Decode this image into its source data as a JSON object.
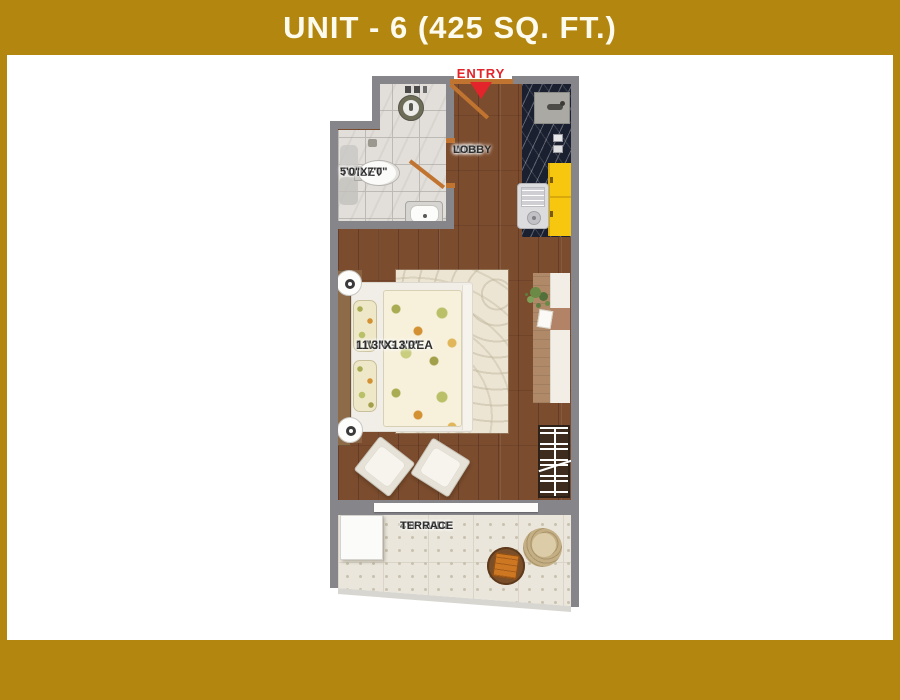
{
  "title": {
    "text": "UNIT - 6 (425 SQ. FT.)"
  },
  "plan": {
    "entry_label": "ENTRY",
    "rooms": {
      "lobby": {
        "line1": "4'0\"",
        "line2": "WIDE",
        "line3": "LOBBY"
      },
      "toilet": {
        "name": "TOILET",
        "size": "5'0\"X7'0\""
      },
      "living": {
        "name": "LIVING AREA",
        "size": "11'3\"X13'0\""
      },
      "terrace": {
        "line1": "4'0\" WIDE",
        "line2": "TERRACE"
      }
    }
  },
  "colors": {
    "frame_gold": "#B3870F",
    "title_text": "#FDFAEE",
    "wall_gray": "#85858A",
    "entry_red": "#E3242B",
    "door_orange": "#C1742F",
    "wood_floor": "#7C4C2E",
    "toilet_tile": "#E2DFDA",
    "terrace_tile": "#EAE6DB",
    "kitchen_counter_black": "#1A2030",
    "cabinet_yellow": "#F7C70F"
  }
}
